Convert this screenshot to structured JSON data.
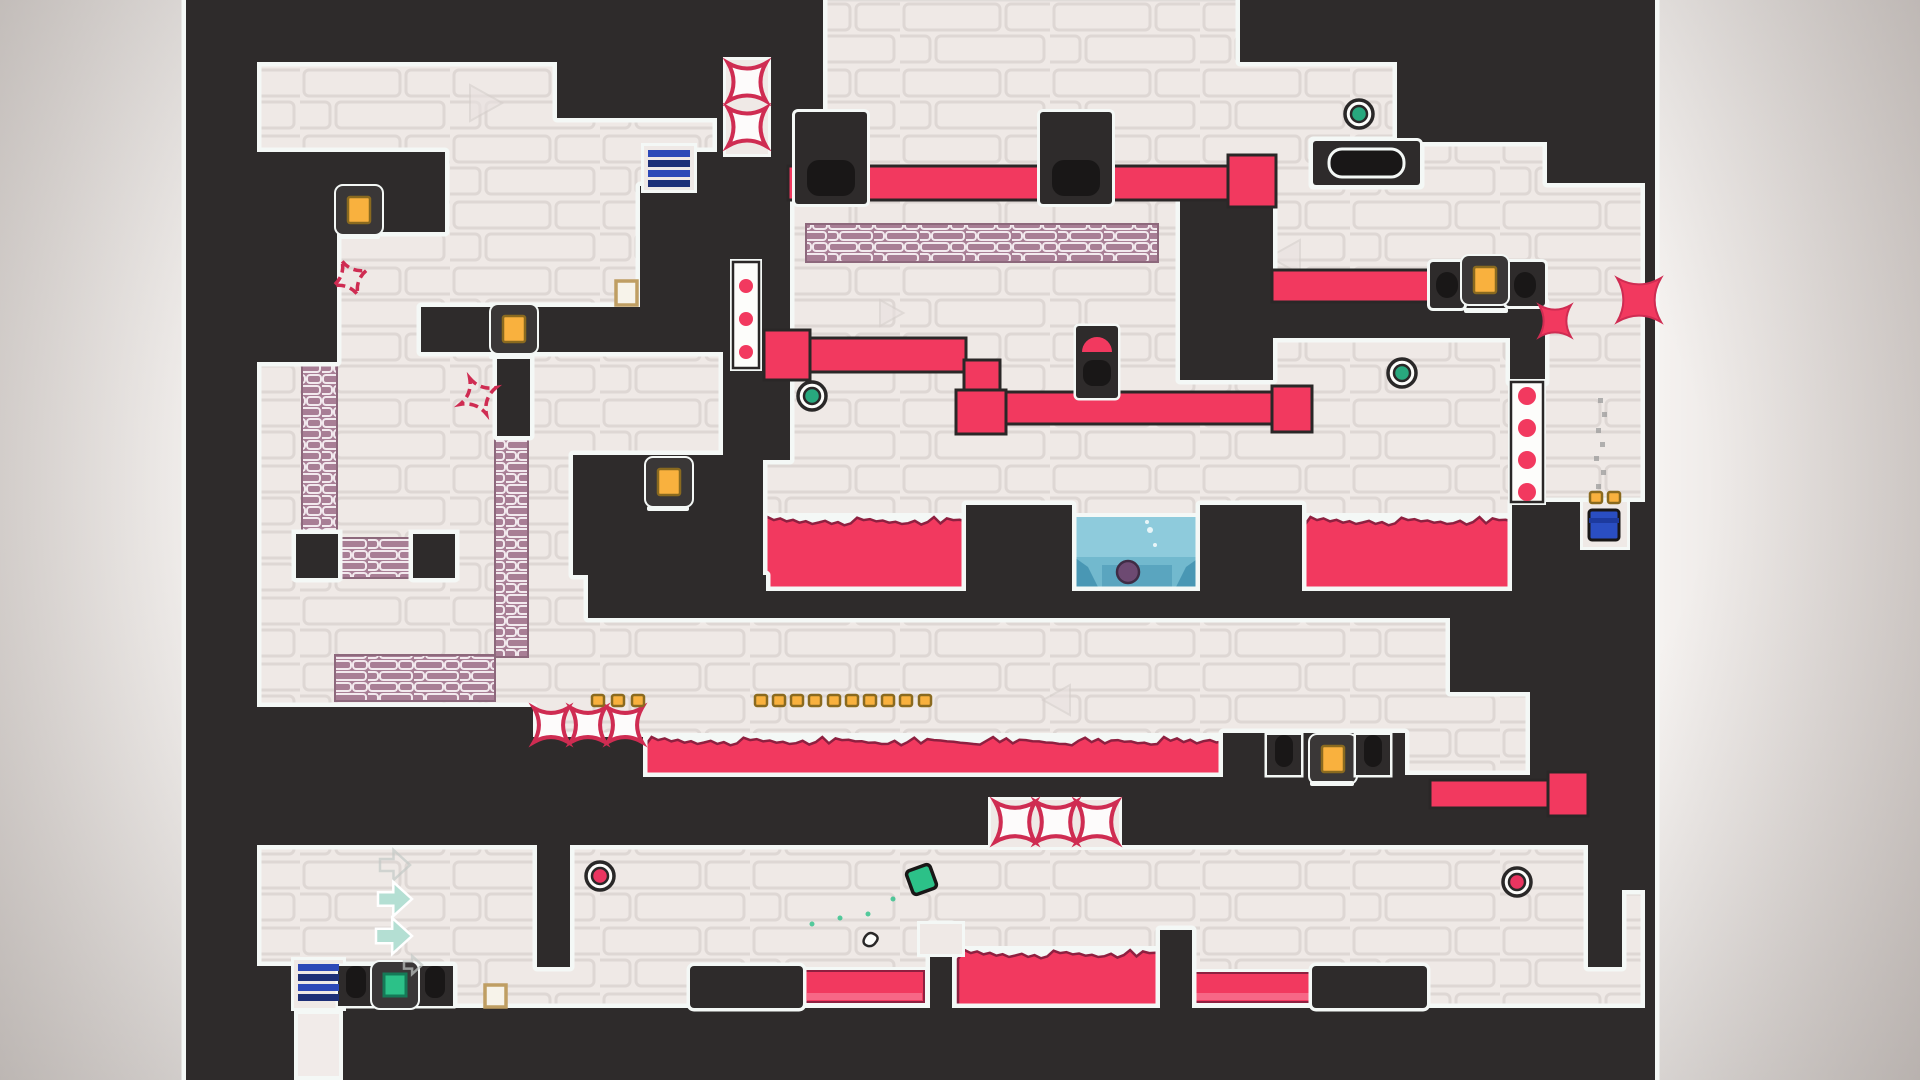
{
  "app": {
    "name": "puzzle-platformer-level",
    "view": "level-screenshot"
  },
  "colors": {
    "dark": "#2e2b2b",
    "outline": "#f4f8f6",
    "brick_bg": "#efe9e6",
    "brick_line": "#ded7d4",
    "lava": "#f2395f",
    "lava_edge": "#8e2040",
    "lava_light": "#f8708d",
    "water": "#8ecbdc",
    "water_deep": "#64afc6",
    "water_decor": "#3e8fae",
    "water_blob": "#6d4a72",
    "mauve": "#a87e95",
    "mauve_line": "#f2e9ee",
    "blue": "#2d49b8",
    "blue_dark": "#1d2f77",
    "bin_blue": "#2a4ec2",
    "amber": "#f9b13e",
    "amber_edge": "#8a6a1f",
    "frame_dark": "#3a3737",
    "green": "#28a87e",
    "red_orb": "#ea3560",
    "crimson": "#cf2c52",
    "mint": "#b4dfd3",
    "char_green": "#2cc188",
    "black": "#191717",
    "dust": "#9b9b9b",
    "beige": "#bf9e63",
    "white_pillar": "#f1ebe9"
  },
  "scene": {
    "level_rect": [
      186,
      0,
      1469,
      1080
    ],
    "dark_blocks": [
      [
        186,
        0,
        71,
        1080
      ],
      [
        257,
        0,
        300,
        62
      ],
      [
        557,
        0,
        160,
        118
      ],
      [
        717,
        0,
        106,
        183
      ],
      [
        1240,
        0,
        415,
        62
      ],
      [
        1397,
        62,
        248,
        80
      ],
      [
        257,
        152,
        188,
        80
      ],
      [
        257,
        232,
        80,
        130
      ],
      [
        688,
        152,
        35,
        36
      ],
      [
        640,
        186,
        83,
        166
      ],
      [
        723,
        183,
        67,
        277
      ],
      [
        421,
        307,
        219,
        45
      ],
      [
        497,
        352,
        33,
        84
      ],
      [
        573,
        455,
        190,
        120
      ],
      [
        588,
        575,
        178,
        43
      ],
      [
        966,
        505,
        106,
        92
      ],
      [
        1180,
        183,
        93,
        197
      ],
      [
        1200,
        505,
        102,
        92
      ],
      [
        1272,
        302,
        271,
        36
      ],
      [
        1510,
        302,
        35,
        80
      ],
      [
        1313,
        141,
        107,
        44
      ],
      [
        1547,
        141,
        108,
        42
      ],
      [
        1645,
        62,
        10,
        1018
      ],
      [
        1512,
        502,
        143,
        116
      ],
      [
        766,
        591,
        749,
        27
      ],
      [
        257,
        707,
        276,
        138
      ],
      [
        533,
        737,
        110,
        108
      ],
      [
        643,
        777,
        580,
        68
      ],
      [
        1223,
        733,
        182,
        112
      ],
      [
        1450,
        618,
        205,
        74
      ],
      [
        1530,
        692,
        125,
        83
      ],
      [
        1405,
        775,
        250,
        70
      ],
      [
        537,
        845,
        33,
        122
      ],
      [
        930,
        925,
        22,
        83
      ],
      [
        1160,
        930,
        32,
        78
      ],
      [
        1588,
        845,
        34,
        122
      ],
      [
        257,
        1008,
        1398,
        72
      ],
      [
        257,
        966,
        196,
        42
      ],
      [
        1622,
        845,
        33,
        45
      ],
      [
        296,
        534,
        42,
        44
      ],
      [
        413,
        534,
        42,
        44
      ]
    ],
    "outlined_blocks": [
      [
        690,
        966,
        113,
        42
      ],
      [
        1312,
        966,
        115,
        42
      ]
    ],
    "white_recesses": [
      [
        726,
        60,
        42,
        94
      ],
      [
        733,
        262,
        26,
        106
      ],
      [
        1511,
        382,
        32,
        120
      ],
      [
        991,
        800,
        128,
        47
      ],
      [
        1583,
        502,
        44,
        45
      ],
      [
        644,
        146,
        50,
        44
      ],
      [
        294,
        960,
        49,
        48
      ],
      [
        920,
        924,
        42,
        30
      ]
    ],
    "mauve_strips": [
      [
        806,
        224,
        352,
        38
      ],
      [
        302,
        360,
        35,
        178
      ],
      [
        337,
        538,
        78,
        40
      ],
      [
        495,
        430,
        33,
        227
      ],
      [
        335,
        655,
        160,
        46
      ]
    ],
    "mauve_nodes": [
      [
        304,
        542
      ],
      [
        421,
        542
      ]
    ],
    "white_underlays": [
      [
        757,
        513,
        213,
        82
      ],
      [
        1070,
        513,
        134,
        82
      ],
      [
        1300,
        513,
        216,
        82
      ],
      [
        641,
        733,
        586,
        48
      ],
      [
        954,
        946,
        212,
        66
      ],
      [
        801,
        967,
        127,
        41
      ],
      [
        1188,
        969,
        128,
        37
      ]
    ],
    "lava_jagged": [
      [
        761,
        517,
        205,
        74
      ],
      [
        1304,
        517,
        208,
        74
      ],
      [
        645,
        737,
        578,
        40
      ],
      [
        958,
        950,
        204,
        58
      ]
    ],
    "lava_flat": [
      [
        805,
        971,
        119,
        31
      ],
      [
        1192,
        973,
        120,
        29
      ]
    ],
    "water_pool": {
      "rect": [
        1074,
        517,
        126,
        74
      ],
      "blob": [
        1128,
        572,
        11
      ],
      "bubbles": [
        [
          1150,
          530,
          3
        ],
        [
          1155,
          545,
          2
        ],
        [
          1147,
          522,
          2
        ]
      ]
    },
    "pipes": [
      [
        788,
        166,
        452,
        34
      ],
      [
        1272,
        270,
        161,
        32
      ],
      [
        772,
        338,
        194,
        34
      ],
      [
        964,
        360,
        36,
        40
      ],
      [
        1004,
        392,
        268,
        32
      ],
      [
        1430,
        780,
        118,
        28
      ]
    ],
    "pipe_caps": [
      [
        764,
        330,
        46,
        50
      ],
      [
        956,
        390,
        50,
        44
      ],
      [
        1272,
        386,
        40,
        46
      ],
      [
        1548,
        772,
        40,
        44
      ],
      [
        1228,
        155,
        48,
        52
      ]
    ],
    "clamps": [
      {
        "rect": [
          795,
          112,
          72,
          92
        ],
        "inner": [
          807,
          160,
          48,
          36
        ]
      },
      {
        "rect": [
          1040,
          112,
          72,
          92
        ],
        "inner": [
          1052,
          160,
          48,
          36
        ]
      },
      {
        "rect": [
          1430,
          262,
          34,
          46
        ],
        "inner": [
          1436,
          272,
          22,
          26
        ]
      },
      {
        "rect": [
          1506,
          262,
          39,
          44
        ],
        "inner": [
          1514,
          272,
          22,
          26
        ]
      }
    ],
    "hole_blocks": [
      {
        "rect": [
          1313,
          141,
          107,
          44
        ],
        "inner": [
          1329,
          149,
          75,
          28
        ]
      }
    ],
    "spikes_burst_outline": [
      [
        747,
        82,
        19
      ],
      [
        747,
        127,
        19
      ],
      [
        551,
        725,
        17
      ],
      [
        588,
        725,
        17
      ],
      [
        625,
        725,
        17
      ],
      [
        1015,
        822,
        20
      ],
      [
        1056,
        822,
        20
      ],
      [
        1097,
        822,
        20
      ]
    ],
    "spikes_burst_solid": [
      [
        1639,
        300,
        22
      ],
      [
        1555,
        321,
        16
      ]
    ],
    "spike_squiggles": [
      [
        350,
        278,
        13
      ],
      [
        478,
        396,
        14
      ]
    ],
    "dot_columns": [
      {
        "x": 733,
        "y": 262,
        "w": 26,
        "h": 106,
        "dots": [
          [
            746,
            286,
            7
          ],
          [
            746,
            319,
            7
          ],
          [
            746,
            352,
            7
          ]
        ]
      },
      {
        "x": 1511,
        "y": 382,
        "w": 32,
        "h": 120,
        "dots": [
          [
            1527,
            396,
            9
          ],
          [
            1527,
            428,
            9
          ],
          [
            1527,
            460,
            9
          ],
          [
            1527,
            492,
            9
          ]
        ]
      }
    ],
    "collectibles": [
      [
        336,
        186
      ],
      [
        491,
        305
      ],
      [
        646,
        458
      ],
      [
        1310,
        735
      ],
      [
        1462,
        256
      ]
    ],
    "mini_dots": [
      [
        592,
        695
      ],
      [
        612,
        695
      ],
      [
        632,
        695
      ],
      [
        755,
        695
      ],
      [
        773,
        695
      ],
      [
        791,
        695
      ],
      [
        809,
        695
      ],
      [
        828,
        695
      ],
      [
        846,
        695
      ],
      [
        864,
        695
      ],
      [
        882,
        695
      ],
      [
        900,
        695
      ],
      [
        919,
        695
      ],
      [
        1590,
        492
      ],
      [
        1608,
        492
      ]
    ],
    "hollow_squares": [
      [
        616,
        281,
        21,
        24
      ],
      [
        485,
        985,
        21,
        22
      ]
    ],
    "orbs_green": [
      [
        1359,
        114
      ],
      [
        812,
        396
      ],
      [
        1402,
        373
      ]
    ],
    "orbs_red": [
      [
        600,
        876
      ],
      [
        1517,
        882
      ]
    ],
    "blue_stacks": [
      {
        "x": 648,
        "y": 150,
        "w": 42,
        "bars": [
          150,
          160,
          170,
          180
        ]
      },
      {
        "x": 298,
        "y": 964,
        "w": 41,
        "bars": [
          964,
          974,
          984,
          994
        ]
      }
    ],
    "white_pillar": [
      296,
      1012,
      45,
      66
    ],
    "blue_bin": {
      "body": [
        1589,
        510,
        30,
        30
      ],
      "lid": [
        1589,
        518,
        30,
        5
      ]
    },
    "gem_block": {
      "frame": [
        372,
        962,
        46,
        46
      ],
      "inner": [
        384,
        974,
        22,
        22
      ]
    },
    "plunger": {
      "frame": [
        1076,
        326,
        42,
        72
      ],
      "dome": [
        1097,
        352,
        15
      ],
      "blob": [
        1083,
        360,
        28,
        26
      ]
    },
    "notches": [
      {
        "outer": [
          338,
          966,
          36,
          40
        ],
        "inner": [
          346,
          966,
          20,
          32
        ]
      },
      {
        "outer": [
          417,
          966,
          36,
          40
        ],
        "inner": [
          425,
          966,
          20,
          32
        ]
      },
      {
        "outer": [
          1267,
          735,
          34,
          40
        ],
        "inner": [
          1275,
          735,
          18,
          32
        ]
      },
      {
        "outer": [
          1356,
          735,
          34,
          40
        ],
        "inner": [
          1364,
          735,
          18,
          32
        ]
      }
    ],
    "rails": [
      [
        338,
        234,
        42,
        5
      ],
      [
        489,
        354,
        44,
        5
      ],
      [
        647,
        506,
        42,
        5
      ],
      [
        1310,
        781,
        44,
        5
      ],
      [
        1464,
        308,
        44,
        5
      ]
    ],
    "arrows": [
      {
        "x": 380,
        "y": 850,
        "s": 30,
        "faint": true
      },
      {
        "x": 378,
        "y": 882,
        "s": 34,
        "faint": false
      },
      {
        "x": 376,
        "y": 918,
        "s": 36,
        "faint": false
      },
      {
        "x": 404,
        "y": 956,
        "s": 18,
        "faint": true
      }
    ],
    "dust_trail": [
      [
        1596,
        428
      ],
      [
        1600,
        442
      ],
      [
        1594,
        456
      ],
      [
        1601,
        470
      ],
      [
        1596,
        484
      ],
      [
        1598,
        398
      ],
      [
        1602,
        412
      ]
    ],
    "triangles": [
      [
        470,
        85,
        36,
        1
      ],
      [
        520,
        320,
        30,
        1
      ],
      [
        660,
        555,
        28,
        -1
      ],
      [
        1300,
        240,
        34,
        -1
      ],
      [
        1070,
        685,
        30,
        -1
      ],
      [
        880,
        300,
        26,
        1
      ]
    ],
    "character": {
      "x": 909,
      "y": 867,
      "size": 25,
      "angle": -20
    },
    "particles": [
      [
        893,
        899
      ],
      [
        868,
        914
      ],
      [
        840,
        918
      ],
      [
        812,
        924
      ]
    ],
    "squiggle_doodle": [
      868,
      932
    ]
  }
}
